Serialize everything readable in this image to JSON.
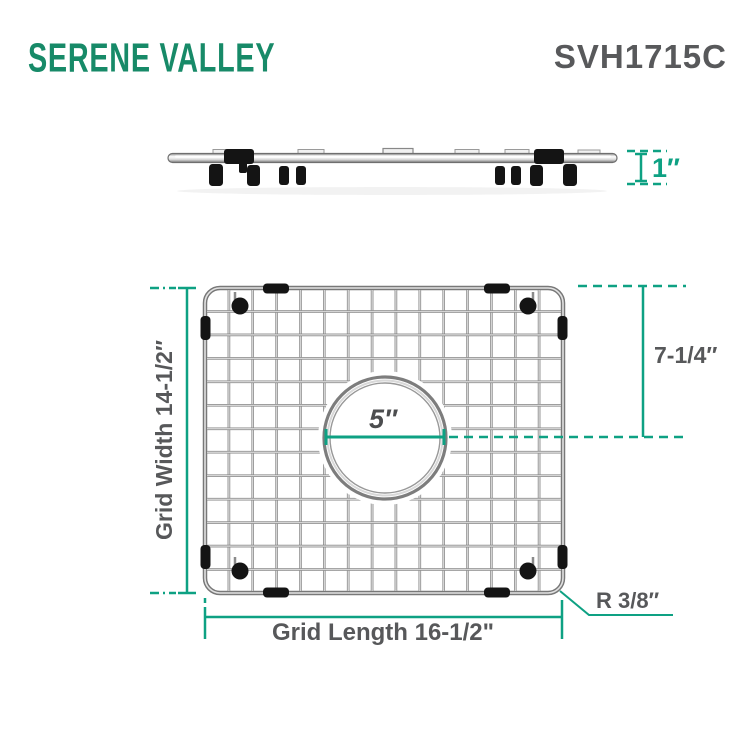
{
  "brand": {
    "logo_text": "SERENE VALLEY",
    "model_number": "SVH1715C"
  },
  "side_view": {
    "height_label": "1″"
  },
  "front_view": {
    "grid_width_label": "Grid Width 14-1/2″",
    "grid_length_label": "Grid Length 16-1/2\"",
    "hole_offset_label": "7-1/4″",
    "hole_diameter_label": "5″",
    "corner_radius_label": "R 3/8″"
  },
  "colors": {
    "accent_teal": "#0EA183",
    "logo_green": "#178A68",
    "label_gray": "#58595B",
    "metal_gray": "#7D7D7D",
    "bumper_black": "#141414"
  }
}
